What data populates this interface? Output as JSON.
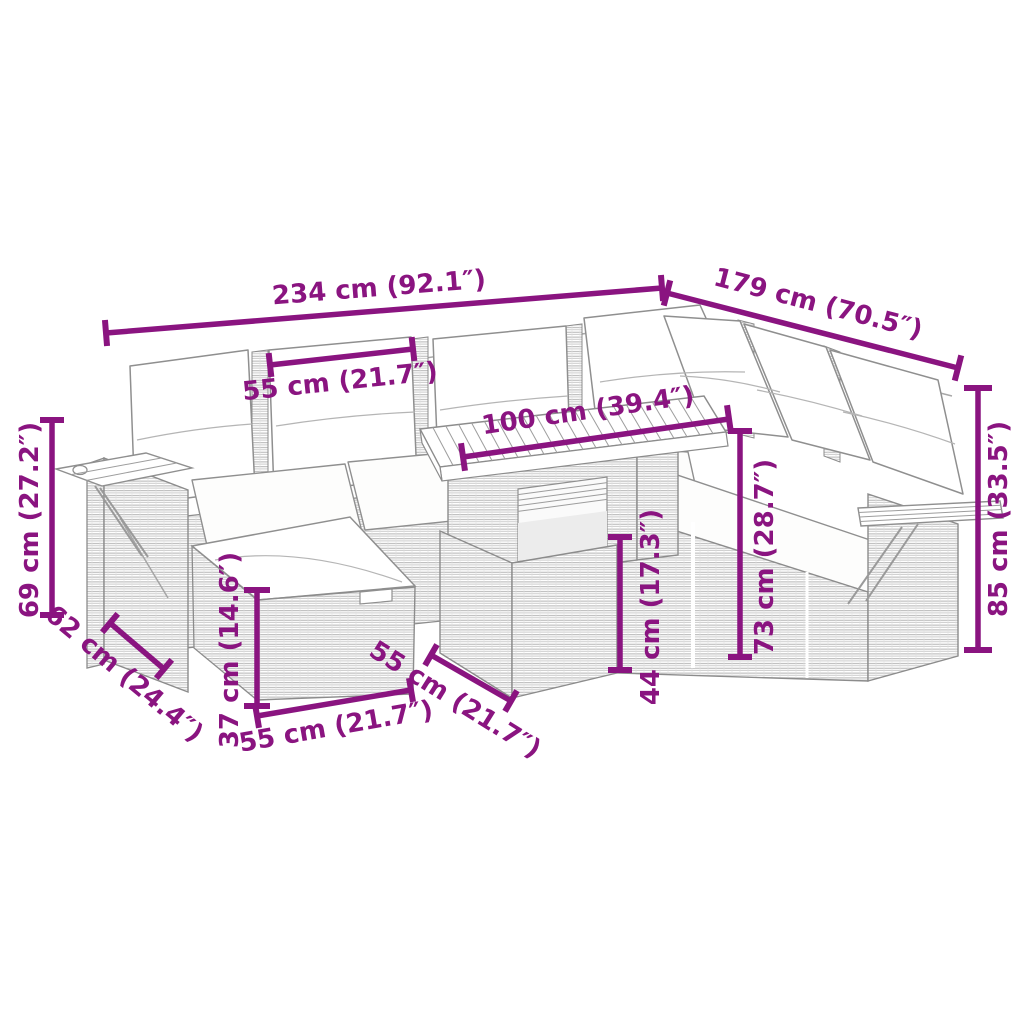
{
  "diagram": {
    "type": "furniture-dimension-diagram",
    "subject": "rattan garden lounge set with white cushions, two ottomans, slatted wood table and fold-out armrest trays",
    "background_color": "#ffffff",
    "accent_color": "#8A1480",
    "line_art_color": "#8c8c8c",
    "unit_primary": "cm",
    "unit_secondary": "inches",
    "dimensions": [
      {
        "id": "total-width-left",
        "label": "234 cm (92.1″)",
        "line": [
          106,
          333,
          662,
          288
        ],
        "text": [
          379,
          288
        ],
        "rotation": -4.5,
        "tick": 26
      },
      {
        "id": "total-width-right",
        "label": "179 cm (70.5″)",
        "line": [
          667,
          293,
          958,
          368
        ],
        "text": [
          818,
          304
        ],
        "rotation": 14.6,
        "tick": 26
      },
      {
        "id": "seat-width-top",
        "label": "55 cm (21.7″)",
        "line": [
          270,
          365,
          413,
          349
        ],
        "text": [
          340,
          382
        ],
        "rotation": -6,
        "tick": 24
      },
      {
        "id": "table-length",
        "label": "100 cm (39.4″)",
        "line": [
          463,
          457,
          729,
          419
        ],
        "text": [
          588,
          411
        ],
        "rotation": -8.2,
        "tick": 28
      },
      {
        "id": "armrest-height",
        "label": "69 cm (27.2″)",
        "line": [
          52,
          420,
          52,
          615
        ],
        "text": [
          30,
          520
        ],
        "rotation": -90,
        "tick": 24
      },
      {
        "id": "seat-depth",
        "label": "62 cm (24.4″)",
        "line": [
          110,
          623,
          164,
          669
        ],
        "text": [
          124,
          674
        ],
        "rotation": 40,
        "tick": 24
      },
      {
        "id": "ottoman-height",
        "label": "37 cm (14.6″)",
        "line": [
          257,
          590,
          257,
          706
        ],
        "text": [
          230,
          650
        ],
        "rotation": -90,
        "tick": 26
      },
      {
        "id": "ottoman-width",
        "label": "55 cm (21.7″)",
        "line": [
          257,
          716,
          411,
          690
        ],
        "text": [
          336,
          727
        ],
        "rotation": -10,
        "tick": 24
      },
      {
        "id": "table-depth",
        "label": "55 cm (21.7″)",
        "line": [
          431,
          655,
          511,
          701
        ],
        "text": [
          455,
          700
        ],
        "rotation": 32,
        "tick": 24
      },
      {
        "id": "table-base-height",
        "label": "44 cm (17.3″)",
        "line": [
          620,
          537,
          620,
          670
        ],
        "text": [
          651,
          607
        ],
        "rotation": -90,
        "tick": 24
      },
      {
        "id": "table-height",
        "label": "73 cm (28.7″)",
        "line": [
          740,
          431,
          740,
          657
        ],
        "text": [
          765,
          557
        ],
        "rotation": -90,
        "tick": 24
      },
      {
        "id": "back-height",
        "label": "85 cm (33.5″)",
        "line": [
          978,
          388,
          978,
          650
        ],
        "text": [
          999,
          519
        ],
        "rotation": -90,
        "tick": 28
      }
    ]
  }
}
